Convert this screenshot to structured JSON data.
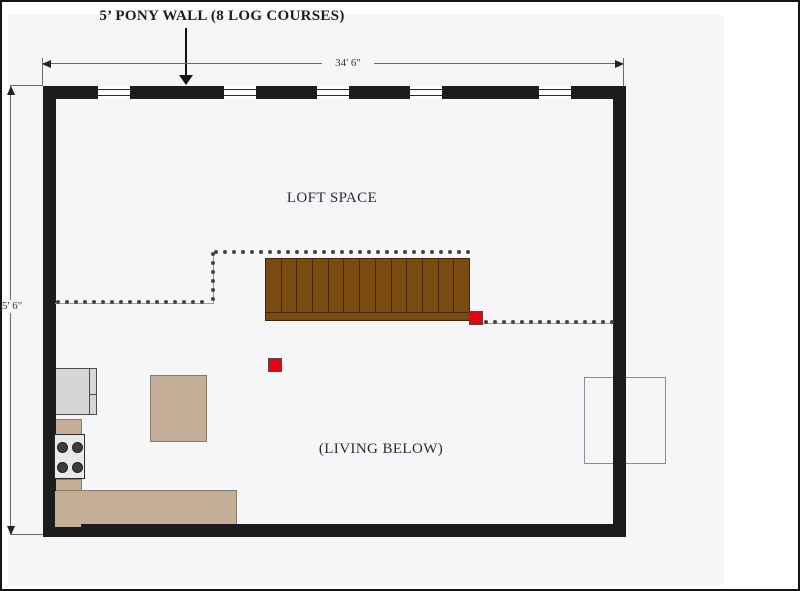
{
  "annotation": {
    "pony_wall_label": "5’ PONY WALL (8 LOG COURSES)"
  },
  "dimensions": {
    "width_label": "34' 6\"",
    "height_label": "5' 6\""
  },
  "rooms": {
    "loft_label": "LOFT SPACE",
    "living_label": "(LIVING BELOW)"
  },
  "colors": {
    "wall": "#1c1c1e",
    "canvas": "#f6f6f9",
    "stair_wood": "#7a4a13",
    "stair_line": "#45290a",
    "furniture_tan": "#c5ae97",
    "appliance_gray": "#d6d6d6",
    "post_red": "#e30613",
    "railing_dot": "#54403d",
    "dimension_line": "#6b6b6b"
  },
  "windows": {
    "count": 5,
    "width": 32,
    "x_positions": [
      96,
      222,
      315,
      408,
      537
    ]
  },
  "stairs": {
    "tread_count": 13
  },
  "railing": {
    "dot_spacing": 9,
    "segments": [
      {
        "name": "left-run",
        "x": 56,
        "y": 300,
        "dx": 9,
        "dy": 0,
        "count": 17
      },
      {
        "name": "step-up",
        "x": 211,
        "y": 252,
        "dx": 0,
        "dy": 9,
        "count": 6
      },
      {
        "name": "top-run",
        "x": 214,
        "y": 250,
        "dx": 9,
        "dy": 0,
        "count": 29
      },
      {
        "name": "right-run",
        "x": 484,
        "y": 320,
        "dx": 9,
        "dy": 0,
        "count": 15
      }
    ]
  }
}
